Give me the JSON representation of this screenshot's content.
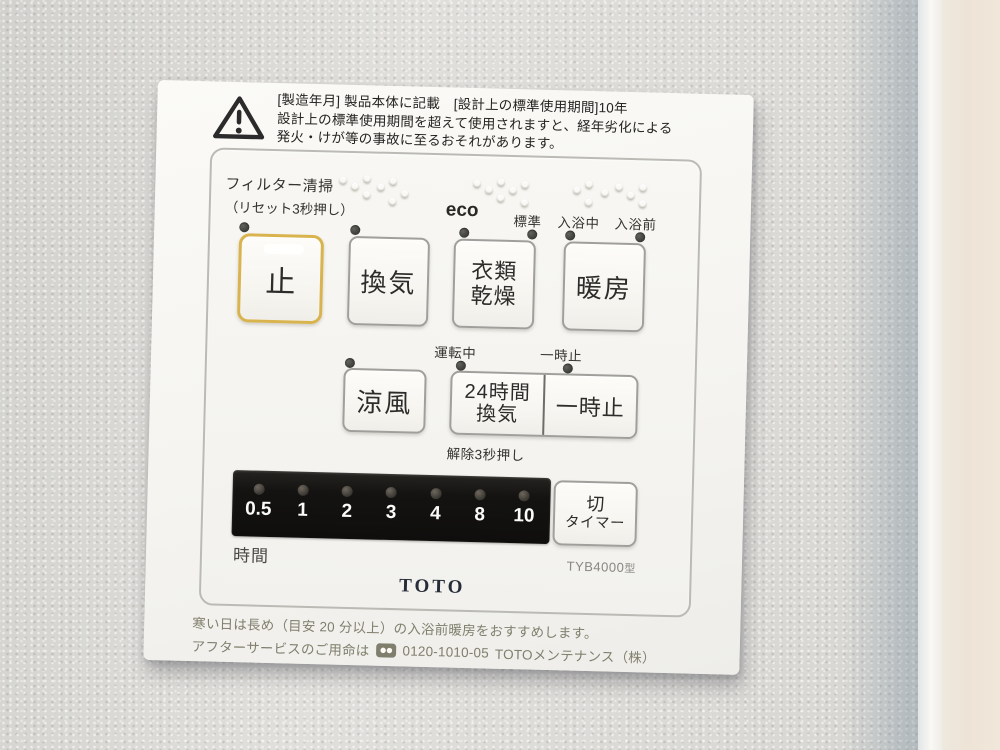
{
  "panel": {
    "warning": {
      "line1": "[製造年月] 製品本体に記載　[設計上の標準使用期間]10年",
      "line2": "設計上の標準使用期間を超えて使用されますと、経年劣化による",
      "line3": "発火・けが等の事故に至るおそれがあります。"
    },
    "filter": {
      "label": "フィルター清掃",
      "sublabel": "（リセット3秒押し）"
    },
    "modes": {
      "eco": "eco",
      "standard": "標準",
      "bathing": "入浴中",
      "prebath": "入浴前"
    },
    "buttons": {
      "stop": "止",
      "ventilation": "換気",
      "clothes_line1": "衣類",
      "clothes_line2": "乾燥",
      "heating": "暖房",
      "cool": "涼風",
      "v24_line1": "24時間",
      "v24_line2": "換気",
      "pause": "一時止",
      "timer_off_line1": "切",
      "timer_off_line2": "タイマー"
    },
    "status": {
      "running": "運転中",
      "pause": "一時止",
      "release_hint": "解除3秒押し"
    },
    "timer": {
      "values": [
        "0.5",
        "1",
        "2",
        "3",
        "4",
        "8",
        "10"
      ],
      "unit": "時間"
    },
    "model": {
      "name": "TYB4000",
      "suffix": "型"
    },
    "brand": "TOTO",
    "notes": {
      "line1": "寒い日は長め（目安 20 分以上）の入浴前暖房をおすすめします。",
      "line2_prefix": "アフターサービスのご用命は",
      "phone": "0120-1010-05",
      "line2_suffix": "TOTOメンテナンス（株）"
    }
  },
  "colors": {
    "stop_button_ring": "#d9b44e",
    "timer_bar": "#141311",
    "panel": "#f6f5f1",
    "wall": "#d9d8d4",
    "led_off": "#3c3c3a",
    "note_text": "#807f6d"
  }
}
